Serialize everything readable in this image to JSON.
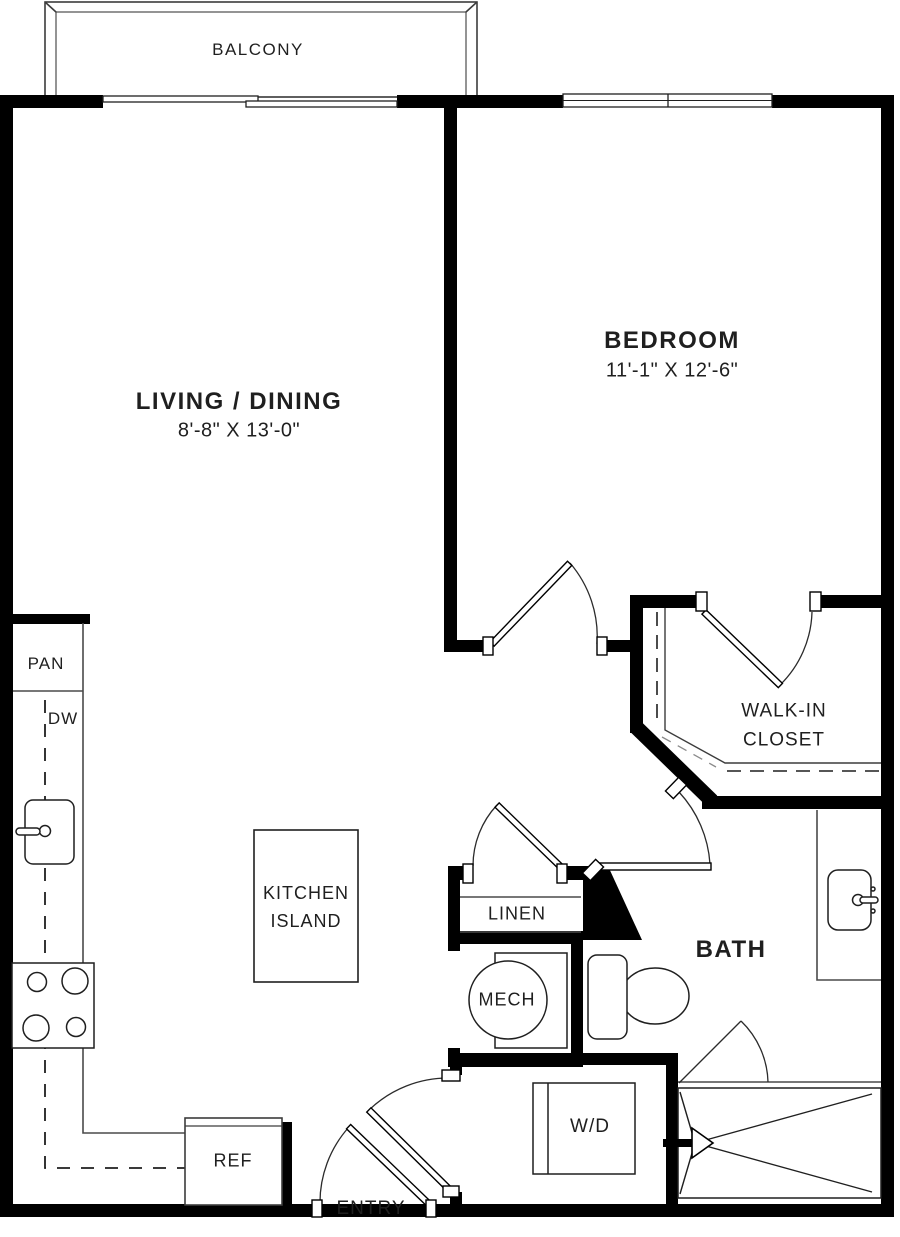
{
  "rooms": {
    "balcony": "BALCONY",
    "living_dining": {
      "name": "LIVING / DINING",
      "dims": "8'-8\" X 13'-0\""
    },
    "bedroom": {
      "name": "BEDROOM",
      "dims": "11'-1\" X 12'-6\""
    },
    "walk_in_closet": {
      "line1": "WALK-IN",
      "line2": "CLOSET"
    },
    "bath": "BATH",
    "entry": "ENTRY"
  },
  "fixtures": {
    "pantry": "PAN",
    "dishwasher": "DW",
    "kitchen_island": {
      "line1": "KITCHEN",
      "line2": "ISLAND"
    },
    "refrigerator": "REF",
    "linen": "LINEN",
    "mechanical": "MECH",
    "washer_dryer": "W/D"
  },
  "colors": {
    "wall": "#000000",
    "line": "#4a4a4a",
    "text": "#1f1f1f",
    "background": "#ffffff"
  }
}
